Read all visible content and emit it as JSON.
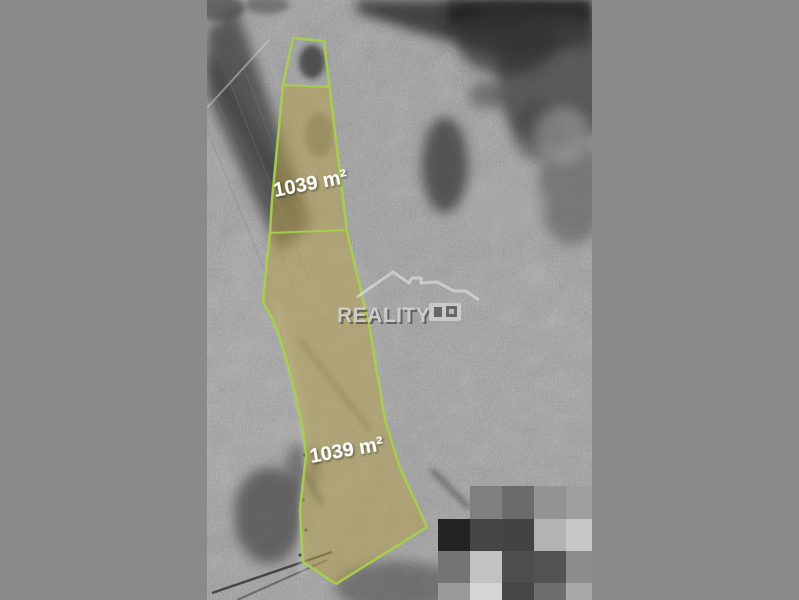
{
  "canvas": {
    "background_color": "#8a8a8a"
  },
  "parcels": {
    "upper_label": "1039 m²",
    "lower_label": "1039 m²",
    "outline_color": "#a7d04c",
    "fill_color": "#b3a14f",
    "label_color": "#ffffff"
  },
  "watermark": {
    "text": "REALITY",
    "icon": "house-roof-icon",
    "color": "#d6d6d6"
  },
  "mosaic": {
    "blocks": [
      {
        "x": 263,
        "y": 486,
        "w": 32,
        "h": 33,
        "color": "#7f7f7f"
      },
      {
        "x": 295,
        "y": 486,
        "w": 32,
        "h": 33,
        "color": "#6b6b6b"
      },
      {
        "x": 327,
        "y": 486,
        "w": 32,
        "h": 33,
        "color": "#949494"
      },
      {
        "x": 359,
        "y": 486,
        "w": 32,
        "h": 33,
        "color": "#9f9f9f"
      },
      {
        "x": 231,
        "y": 519,
        "w": 32,
        "h": 32,
        "color": "#232323"
      },
      {
        "x": 263,
        "y": 519,
        "w": 32,
        "h": 32,
        "color": "#454545"
      },
      {
        "x": 295,
        "y": 519,
        "w": 32,
        "h": 32,
        "color": "#434343"
      },
      {
        "x": 327,
        "y": 519,
        "w": 32,
        "h": 32,
        "color": "#b3b3b3"
      },
      {
        "x": 359,
        "y": 519,
        "w": 32,
        "h": 32,
        "color": "#c7c7c7"
      },
      {
        "x": 231,
        "y": 551,
        "w": 32,
        "h": 32,
        "color": "#747474"
      },
      {
        "x": 263,
        "y": 551,
        "w": 32,
        "h": 32,
        "color": "#c2c2c2"
      },
      {
        "x": 295,
        "y": 551,
        "w": 32,
        "h": 32,
        "color": "#4e4e4e"
      },
      {
        "x": 327,
        "y": 551,
        "w": 32,
        "h": 32,
        "color": "#535353"
      },
      {
        "x": 359,
        "y": 551,
        "w": 32,
        "h": 32,
        "color": "#8d8d8d"
      },
      {
        "x": 231,
        "y": 583,
        "w": 32,
        "h": 17,
        "color": "#9a9a9a"
      },
      {
        "x": 263,
        "y": 583,
        "w": 32,
        "h": 17,
        "color": "#d5d5d5"
      },
      {
        "x": 295,
        "y": 583,
        "w": 32,
        "h": 17,
        "color": "#474747"
      },
      {
        "x": 327,
        "y": 583,
        "w": 32,
        "h": 17,
        "color": "#6e6e6e"
      },
      {
        "x": 359,
        "y": 583,
        "w": 32,
        "h": 17,
        "color": "#a9a9a9"
      }
    ]
  }
}
